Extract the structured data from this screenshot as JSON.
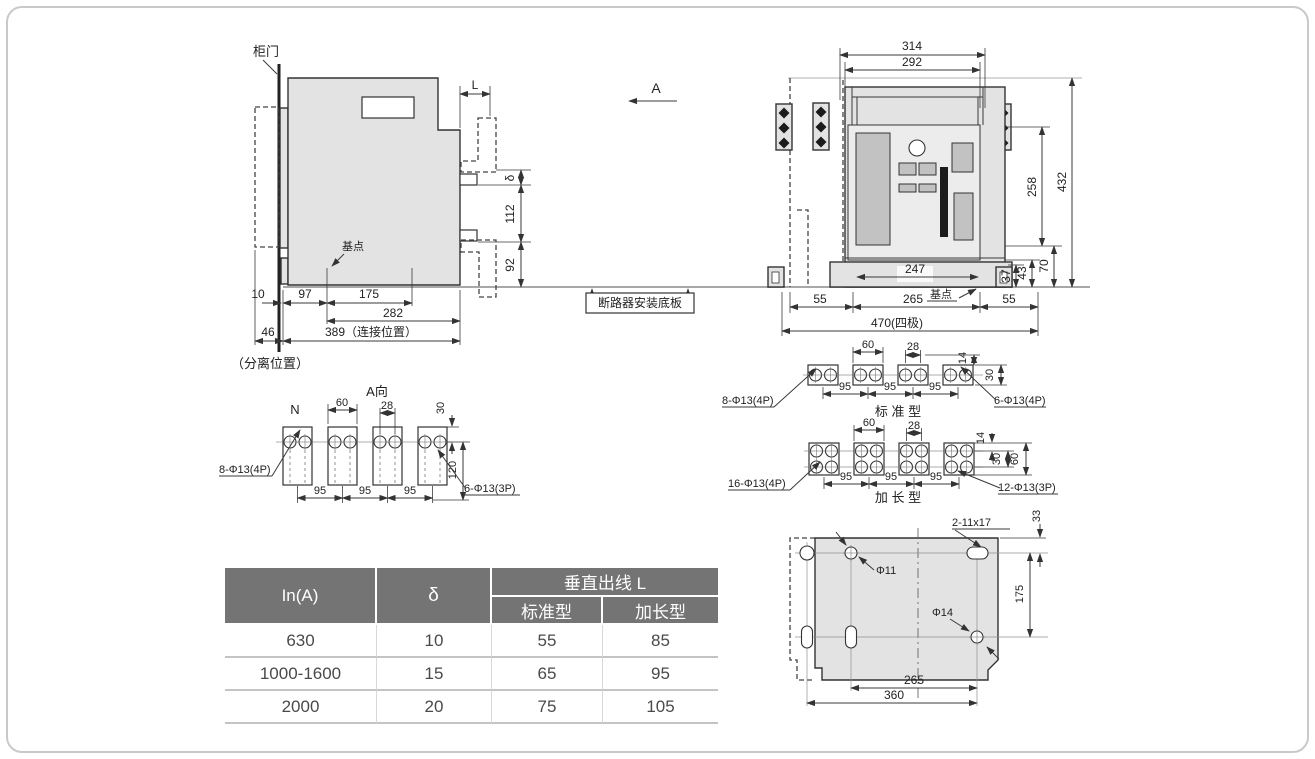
{
  "labels": {
    "door": "柜门",
    "base_point": "基点",
    "mount_plate": "断路器安装底板",
    "separated": "（分离位置）",
    "a_view_title": "A向",
    "view_arrow": "A",
    "n_pole": "N",
    "std_title": "标 准 型",
    "ext_title": "加 长 型",
    "holes_8_4p": "8-Φ13(4P)",
    "holes_6_3p": "6-Φ13(3P)",
    "holes_6_4p": "6-Φ13(4P)",
    "holes_16_4p": "16-Φ13(4P)",
    "holes_12_3p": "12-Φ13(3P)",
    "slot_11x17": "2-11x17",
    "phi11": "Φ11",
    "phi14": "Φ14"
  },
  "dims": {
    "L": "L",
    "delta": "δ",
    "d10": "10",
    "d14": "14",
    "d28": "28",
    "d30": "30",
    "d33": "33",
    "d37": "37",
    "d43": "43",
    "d46": "46",
    "d55": "55",
    "d60": "60",
    "d70": "70",
    "d92": "92",
    "d95": "95",
    "d97": "97",
    "d112": "112",
    "d120": "120",
    "d175": "175",
    "d247": "247",
    "d258": "258",
    "d265": "265",
    "d282": "282",
    "d292": "292",
    "d314": "314",
    "d360": "360",
    "d389": "389（连接位置）",
    "d432": "432",
    "d470": "470(四极)"
  },
  "table": {
    "c_in": "In(A)",
    "c_delta": "δ",
    "c_group": "垂直出线 L",
    "c_std": "标准型",
    "c_ext": "加长型",
    "rows": [
      [
        "630",
        "10",
        "55",
        "85"
      ],
      [
        "1000-1600",
        "15",
        "65",
        "95"
      ],
      [
        "2000",
        "20",
        "75",
        "105"
      ]
    ]
  },
  "colors": {
    "body_fill": "#e3e3e3",
    "header_bg": "#747474",
    "line": "#333333",
    "black_bar": "#1b1b1b"
  }
}
